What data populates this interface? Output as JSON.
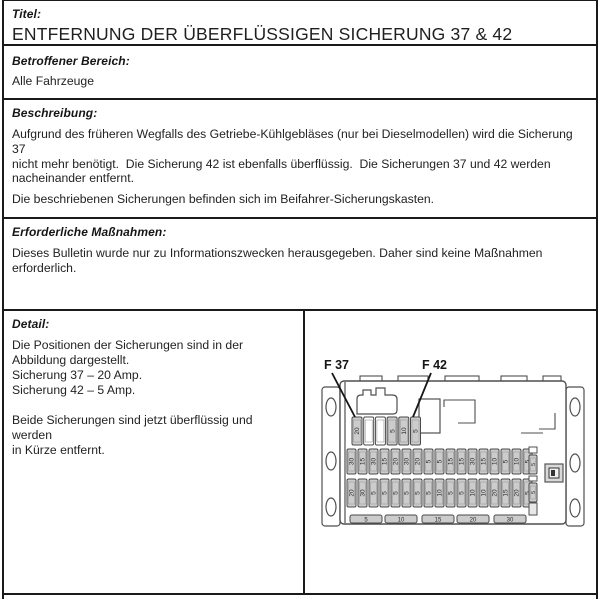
{
  "document": {
    "titel_label": "Titel:",
    "title": "ENTFERNUNG DER ÜBERFLÜSSIGEN SICHERUNG 37 & 42",
    "bereich_label": "Betroffener Bereich:",
    "bereich_text": "Alle Fahrzeuge",
    "beschreibung_label": "Beschreibung:",
    "beschreibung_lines": [
      "Aufgrund des früheren Wegfalls des Getriebe-Kühlgebläses (nur bei Dieselmodellen) wird die Sicherung 37",
      "nicht mehr benötigt.  Die Sicherung 42 ist ebenfalls überflüssig.  Die Sicherungen 37 und 42 werden",
      "nacheinander entfernt."
    ],
    "beschreibung_para2": "Die beschriebenen Sicherungen befinden sich im Beifahrer-Sicherungskasten.",
    "massnahmen_label": "Erforderliche Maßnahmen:",
    "massnahmen_lines": [
      "Dieses Bulletin wurde nur zu Informationszwecken herausgegeben. Daher sind keine Maßnahmen",
      "erforderlich."
    ],
    "detail_label": "Detail:",
    "detail_lines": [
      "Die Positionen der Sicherungen sind in der",
      "Abbildung dargestellt.",
      "Sicherung 37 – 20 Amp.",
      "Sicherung 42 – 5 Amp.",
      "",
      "Beide Sicherungen sind jetzt überflüssig und werden",
      "in Kürze entfernt."
    ]
  },
  "diagram": {
    "callout_f37": "F 37",
    "callout_f42": "F 42",
    "top_row": [
      "20",
      "",
      "",
      "5",
      "10",
      "5"
    ],
    "middle_row": [
      "30",
      "15",
      "30",
      "15",
      "20",
      "30",
      "20",
      "5",
      "5",
      "15",
      "15",
      "30",
      "15",
      "10",
      "5",
      "10",
      "5",
      "5"
    ],
    "bottom_row": [
      "20",
      "30",
      "5",
      "5",
      "5",
      "5",
      "5",
      "5",
      "10",
      "5",
      "5",
      "10",
      "10",
      "20",
      "15",
      "20",
      "5",
      "5"
    ],
    "spare_row": [
      "5",
      "10",
      "15",
      "20",
      "30"
    ]
  },
  "colors": {
    "border": "#1a1a1a",
    "text": "#1c1c1c",
    "fuse_fill": "#cccccc",
    "fuse_stroke": "#4a4a4a",
    "outline": "#4f4f4f"
  }
}
